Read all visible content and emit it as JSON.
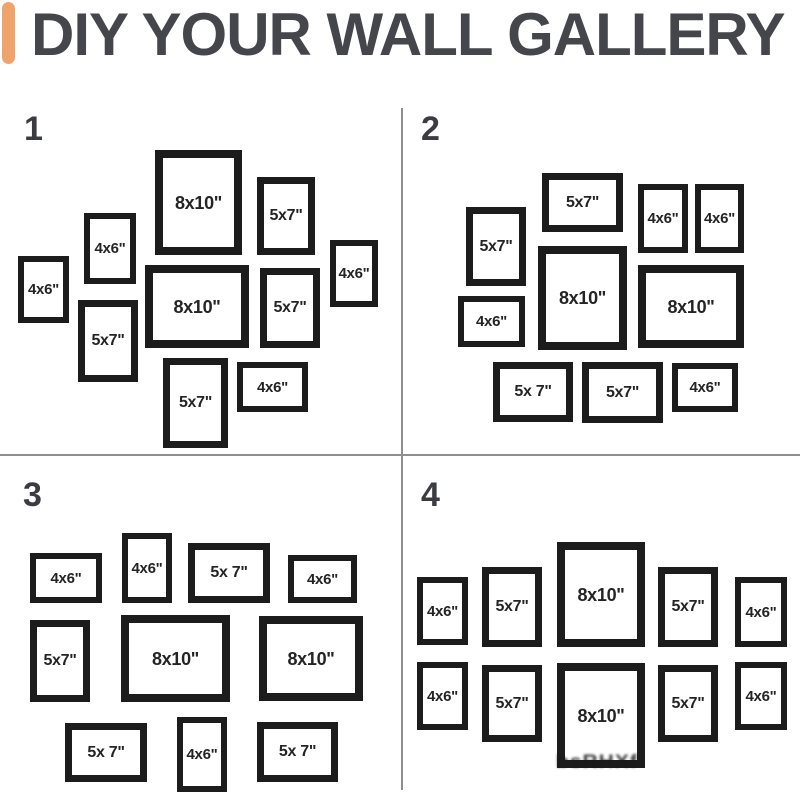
{
  "header": {
    "title": "DIY YOUR WALL GALLERY"
  },
  "colors": {
    "accent_bar": "#F0A46C",
    "title_text": "#45464B",
    "frame_border": "#1C1C1C",
    "divider": "#8F8F8F"
  },
  "watermark": {
    "text": "bsRHXf"
  },
  "layouts": [
    {
      "number": "1",
      "number_pos": {
        "x": 24,
        "y": 112
      },
      "frames": [
        {
          "label": "8x10\"",
          "size": "8x10",
          "x": 155,
          "y": 150,
          "w": 87,
          "h": 105
        },
        {
          "label": "5x7\"",
          "size": "5x7",
          "x": 257,
          "y": 177,
          "w": 58,
          "h": 78
        },
        {
          "label": "4x6\"",
          "size": "4x6",
          "x": 84,
          "y": 213,
          "w": 52,
          "h": 71
        },
        {
          "label": "4x6\"",
          "size": "4x6",
          "x": 18,
          "y": 256,
          "w": 51,
          "h": 67
        },
        {
          "label": "8x10\"",
          "size": "8x10",
          "x": 145,
          "y": 265,
          "w": 104,
          "h": 83
        },
        {
          "label": "5x7\"",
          "size": "5x7",
          "x": 260,
          "y": 268,
          "w": 60,
          "h": 80
        },
        {
          "label": "4x6\"",
          "size": "4x6",
          "x": 330,
          "y": 240,
          "w": 48,
          "h": 67
        },
        {
          "label": "5x7\"",
          "size": "5x7",
          "x": 78,
          "y": 300,
          "w": 60,
          "h": 82
        },
        {
          "label": "5x7\"",
          "size": "5x7",
          "x": 163,
          "y": 358,
          "w": 65,
          "h": 90
        },
        {
          "label": "4x6\"",
          "size": "4x6",
          "x": 237,
          "y": 362,
          "w": 71,
          "h": 50
        }
      ]
    },
    {
      "number": "2",
      "number_pos": {
        "x": 421,
        "y": 112
      },
      "frames": [
        {
          "label": "5x7\"",
          "size": "5x7",
          "x": 542,
          "y": 173,
          "w": 81,
          "h": 59
        },
        {
          "label": "4x6\"",
          "size": "4x6",
          "x": 638,
          "y": 184,
          "w": 50,
          "h": 69
        },
        {
          "label": "4x6\"",
          "size": "4x6",
          "x": 695,
          "y": 184,
          "w": 49,
          "h": 69
        },
        {
          "label": "5x7\"",
          "size": "5x7",
          "x": 466,
          "y": 207,
          "w": 60,
          "h": 79
        },
        {
          "label": "8x10\"",
          "size": "8x10",
          "x": 538,
          "y": 246,
          "w": 89,
          "h": 104
        },
        {
          "label": "8x10\"",
          "size": "8x10",
          "x": 638,
          "y": 265,
          "w": 106,
          "h": 83
        },
        {
          "label": "4x6\"",
          "size": "4x6",
          "x": 458,
          "y": 296,
          "w": 67,
          "h": 51
        },
        {
          "label": "5x 7\"",
          "size": "5x7",
          "x": 493,
          "y": 362,
          "w": 80,
          "h": 60
        },
        {
          "label": "5x7\"",
          "size": "5x7",
          "x": 582,
          "y": 362,
          "w": 81,
          "h": 61
        },
        {
          "label": "4x6\"",
          "size": "4x6",
          "x": 672,
          "y": 363,
          "w": 66,
          "h": 49
        }
      ]
    },
    {
      "number": "3",
      "number_pos": {
        "x": 23,
        "y": 478
      },
      "frames": [
        {
          "label": "4x6\"",
          "size": "4x6",
          "x": 30,
          "y": 553,
          "w": 72,
          "h": 50
        },
        {
          "label": "4x6\"",
          "size": "4x6",
          "x": 122,
          "y": 533,
          "w": 50,
          "h": 70
        },
        {
          "label": "5x 7\"",
          "size": "5x7",
          "x": 188,
          "y": 543,
          "w": 82,
          "h": 60
        },
        {
          "label": "4x6\"",
          "size": "4x6",
          "x": 288,
          "y": 555,
          "w": 69,
          "h": 48
        },
        {
          "label": "5x7\"",
          "size": "5x7",
          "x": 30,
          "y": 620,
          "w": 60,
          "h": 82
        },
        {
          "label": "8x10\"",
          "size": "8x10",
          "x": 121,
          "y": 615,
          "w": 109,
          "h": 87
        },
        {
          "label": "8x10\"",
          "size": "8x10",
          "x": 259,
          "y": 616,
          "w": 104,
          "h": 85
        },
        {
          "label": "5x 7\"",
          "size": "5x7",
          "x": 65,
          "y": 723,
          "w": 82,
          "h": 59
        },
        {
          "label": "4x6\"",
          "size": "4x6",
          "x": 177,
          "y": 717,
          "w": 50,
          "h": 75
        },
        {
          "label": "5x 7\"",
          "size": "5x7",
          "x": 257,
          "y": 722,
          "w": 81,
          "h": 60
        }
      ]
    },
    {
      "number": "4",
      "number_pos": {
        "x": 421,
        "y": 478
      },
      "frames": [
        {
          "label": "4x6\"",
          "size": "4x6",
          "x": 417,
          "y": 577,
          "w": 51,
          "h": 68
        },
        {
          "label": "5x7\"",
          "size": "5x7",
          "x": 482,
          "y": 567,
          "w": 60,
          "h": 80
        },
        {
          "label": "8x10\"",
          "size": "8x10",
          "x": 557,
          "y": 542,
          "w": 88,
          "h": 105
        },
        {
          "label": "5x7\"",
          "size": "5x7",
          "x": 658,
          "y": 567,
          "w": 60,
          "h": 80
        },
        {
          "label": "4x6\"",
          "size": "4x6",
          "x": 735,
          "y": 577,
          "w": 52,
          "h": 70
        },
        {
          "label": "4x6\"",
          "size": "4x6",
          "x": 417,
          "y": 662,
          "w": 51,
          "h": 68
        },
        {
          "label": "5x7\"",
          "size": "5x7",
          "x": 482,
          "y": 665,
          "w": 60,
          "h": 77
        },
        {
          "label": "8x10\"",
          "size": "8x10",
          "x": 557,
          "y": 663,
          "w": 88,
          "h": 105
        },
        {
          "label": "5x7\"",
          "size": "5x7",
          "x": 658,
          "y": 665,
          "w": 60,
          "h": 77
        },
        {
          "label": "4x6\"",
          "size": "4x6",
          "x": 735,
          "y": 662,
          "w": 52,
          "h": 68
        }
      ]
    }
  ]
}
